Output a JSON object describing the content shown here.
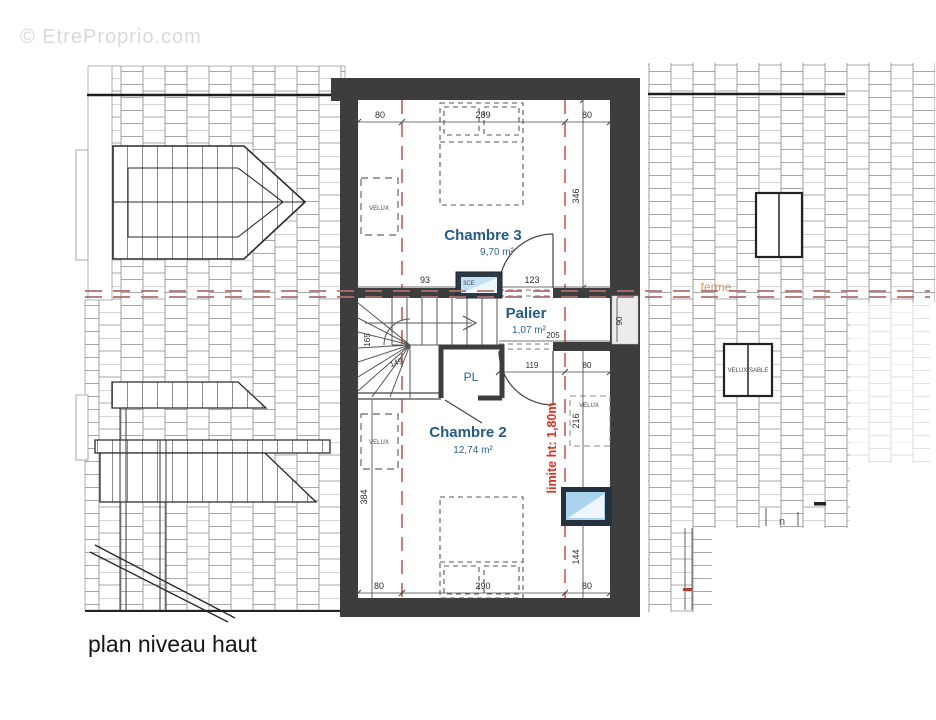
{
  "watermark": "© EtreProprio.com",
  "plan_title": "plan niveau haut",
  "rooms": {
    "chambre3": {
      "name": "Chambre 3",
      "area": "9,70 m²"
    },
    "palier": {
      "name": "Palier",
      "area": "1,07 m²"
    },
    "chambre2": {
      "name": "Chambre 2",
      "area": "12,74 m²"
    },
    "closet": {
      "name": "PL"
    }
  },
  "annotations": {
    "limite": "limite ht: 1,80m",
    "ferme": "ferme",
    "velux": "VELUX",
    "velux_sable": "VELUX SABLE",
    "window_code": "3CE",
    "note_n": "n"
  },
  "dimensions": {
    "top": [
      "80",
      "289",
      "80"
    ],
    "bottom": [
      "80",
      "290",
      "80"
    ],
    "chambre3_right": "346",
    "chambre3_bottom": [
      "93",
      "123"
    ],
    "stairs": [
      "165",
      "149"
    ],
    "palier": [
      "90",
      "205",
      "119",
      "80"
    ],
    "chambre2_left": "384",
    "chambre2_right": [
      "216",
      "144"
    ]
  },
  "colors": {
    "wall": "#3d3d3d",
    "room_label": "#235c87",
    "limite_red": "#e0301e",
    "axis_red": "#b06e6e",
    "ferme_orange": "#d99a55",
    "glass_blue": "#a9d3ee",
    "watermark_gray": "#d9d9d9"
  }
}
